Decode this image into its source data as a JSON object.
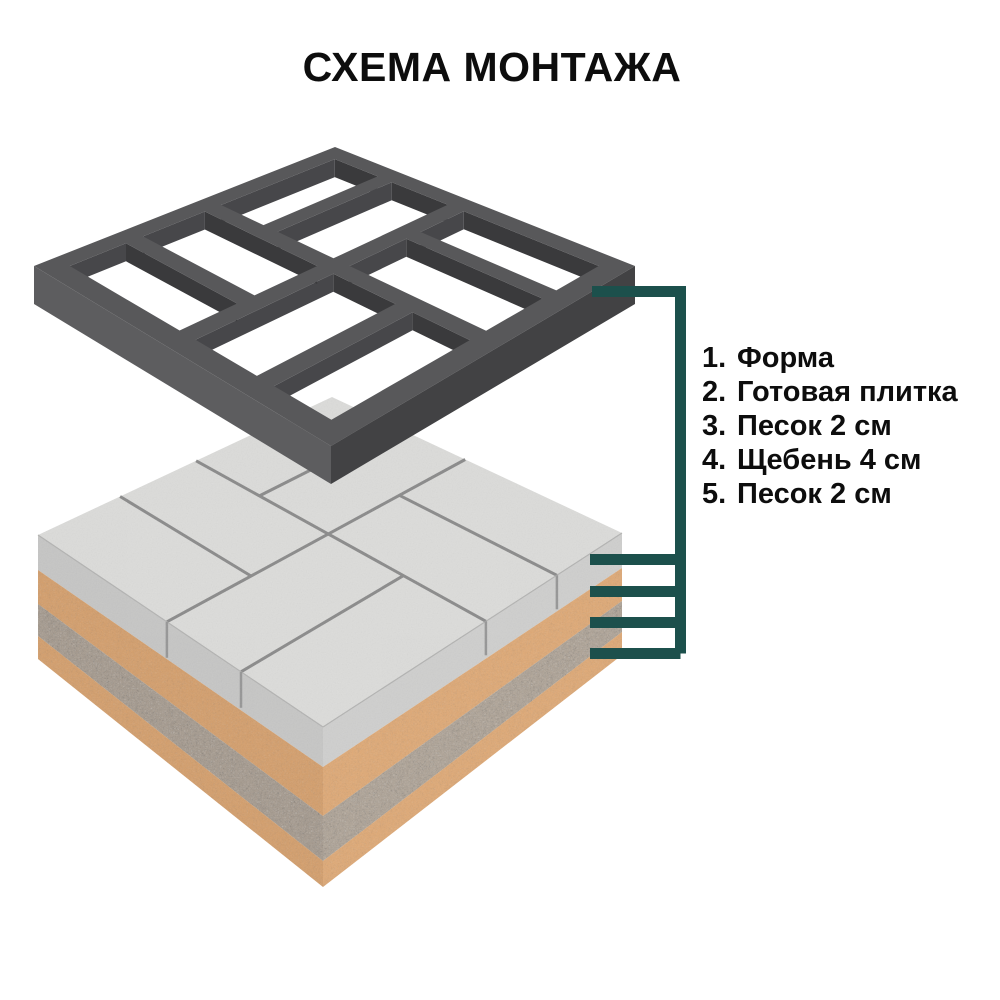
{
  "title": "СХЕМА МОНТАЖА",
  "legend": {
    "items": [
      {
        "number": "1.",
        "label": "Форма"
      },
      {
        "number": "2.",
        "label": "Готовая плитка"
      },
      {
        "number": "3.",
        "label": "Песок 2 см"
      },
      {
        "number": "4.",
        "label": "Щебень 4 см"
      },
      {
        "number": "5.",
        "label": "Песок 2 см"
      }
    ]
  },
  "colors": {
    "background": "#ffffff",
    "accent_teal": "#1c504c",
    "text": "#0d0d0d",
    "mold_top": "#58585a",
    "mold_wall_left": "#5d5d5f",
    "mold_wall_right": "#424244",
    "mold_wall_inner_u": "#3a3a3c",
    "mold_wall_inner_v": "#47474a",
    "tile_top": "#dcdcda",
    "tile_side_left": "#c6c6c5",
    "tile_side_right": "#cfcfce",
    "sand_left": "#d7a06c",
    "sand_right": "#e2ab76",
    "gravel_left": "#a99d90",
    "gravel_right": "#b3a799",
    "groove": "#8a8a8a"
  }
}
